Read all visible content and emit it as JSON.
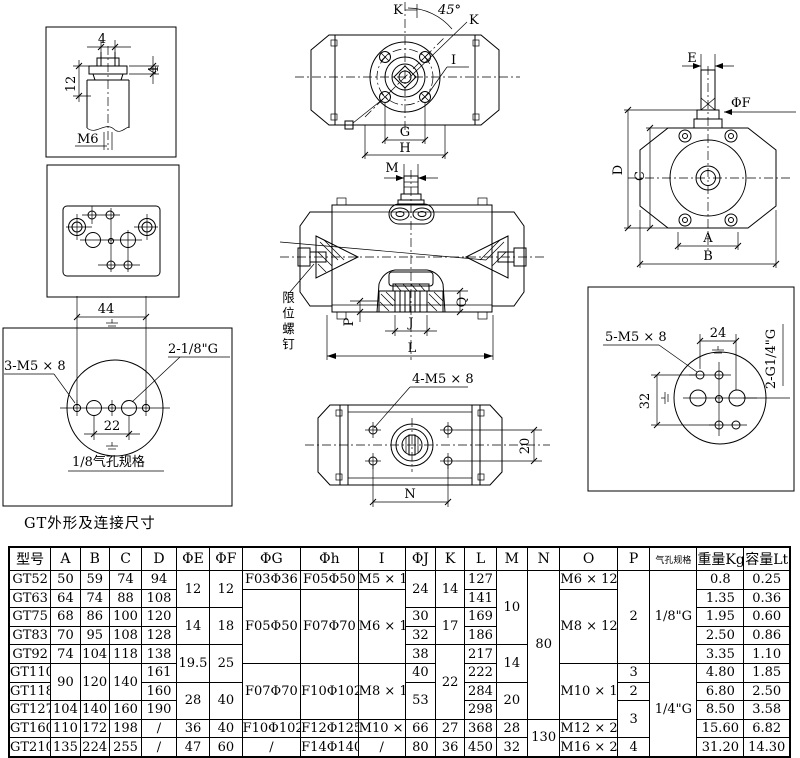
{
  "title": "GT外形及连接尺寸",
  "drawings": {
    "shaft_detail": {
      "slot_width": "4",
      "flange_thickness": "4",
      "height": "12",
      "thread": "M6"
    },
    "mount_plate": {
      "hole_spacing": "44"
    },
    "air_ports_small": {
      "screw_label": "3-M5 × 8",
      "port_label": "2-1/8\"G",
      "hole_spacing": "22",
      "caption": "1/8气孔规格"
    },
    "top_view": {
      "dim_k": "K",
      "angle": "45°",
      "dim_k2": "K",
      "label_i": "I",
      "dim_g": "G",
      "dim_h": "H"
    },
    "front_view": {
      "dim_m": "M",
      "limit_screw_label": "限位螺钉",
      "dim_p": "P",
      "dim_q": "Q",
      "dim_j": "J",
      "dim_l": "L"
    },
    "bottom_view": {
      "screw_label": "4-M5 × 8",
      "hole_spacing_v": "20",
      "dim_n": "N"
    },
    "end_view": {
      "dim_e": "E",
      "dim_f": "ΦF",
      "dim_d": "D",
      "dim_c": "C",
      "dim_a": "A",
      "dim_b": "B"
    },
    "air_ports_large": {
      "screw_label": "5-M5 × 8",
      "hole_spacing_h": "24",
      "port_label": "2-G1/4\"G",
      "hole_spacing_v": "32"
    }
  },
  "table": {
    "columns": [
      "型号",
      "A",
      "B",
      "C",
      "D",
      "ΦE",
      "ΦF",
      "ΦG",
      "Φh",
      "I",
      "ΦJ",
      "K",
      "L",
      "M",
      "N",
      "O",
      "P",
      "气孔规格",
      "重量Kg",
      "容量Lt"
    ],
    "rows": [
      [
        [
          "GT52"
        ],
        [
          "50"
        ],
        [
          "59"
        ],
        [
          "74"
        ],
        [
          "94"
        ],
        [
          "12",
          2
        ],
        [
          "12",
          2
        ],
        [
          "F03Φ36"
        ],
        [
          "F05Φ50"
        ],
        [
          "M5 × 10"
        ],
        [
          "24",
          2
        ],
        [
          "14",
          2
        ],
        [
          "127"
        ],
        [
          "10",
          4
        ],
        [
          "80",
          8
        ],
        [
          "M6 × 12"
        ],
        [
          "2",
          5
        ],
        [
          "1/8\"G",
          5
        ],
        [
          "0.8"
        ],
        [
          "0.25"
        ]
      ],
      [
        [
          "GT63"
        ],
        [
          "64"
        ],
        [
          "74"
        ],
        [
          "88"
        ],
        [
          "108"
        ],
        [
          "F05Φ50",
          4
        ],
        [
          "F07Φ70",
          4
        ],
        [
          "M6 × 10",
          4
        ],
        [
          "141"
        ],
        [
          "M8 × 12",
          4
        ],
        [
          "1.35"
        ],
        [
          "0.36"
        ]
      ],
      [
        [
          "GT75"
        ],
        [
          "68"
        ],
        [
          "86"
        ],
        [
          "100"
        ],
        [
          "120"
        ],
        [
          "14",
          2
        ],
        [
          "18",
          2
        ],
        [
          "30"
        ],
        [
          "17",
          2
        ],
        [
          "169"
        ],
        [
          "1.95"
        ],
        [
          "0.60"
        ]
      ],
      [
        [
          "GT83"
        ],
        [
          "70"
        ],
        [
          "95"
        ],
        [
          "108"
        ],
        [
          "128"
        ],
        [
          "32"
        ],
        [
          "186"
        ],
        [
          "2.50"
        ],
        [
          "0.86"
        ]
      ],
      [
        [
          "GT92"
        ],
        [
          "74"
        ],
        [
          "104"
        ],
        [
          "118"
        ],
        [
          "138"
        ],
        [
          "19.5",
          2
        ],
        [
          "25",
          2
        ],
        [
          "38"
        ],
        [
          "22",
          4
        ],
        [
          "217"
        ],
        [
          "14",
          2
        ],
        [
          "3.35"
        ],
        [
          "1.10"
        ]
      ],
      [
        [
          "GT110"
        ],
        [
          "90",
          2
        ],
        [
          "120",
          2
        ],
        [
          "140",
          2
        ],
        [
          "161"
        ],
        [
          "F07Φ70",
          3
        ],
        [
          "F10Φ102",
          3
        ],
        [
          "M8 × 12",
          3
        ],
        [
          "40"
        ],
        [
          "222"
        ],
        [
          "M10 × 16",
          3
        ],
        [
          "3"
        ],
        [
          "1/4\"G",
          5
        ],
        [
          "4.80"
        ],
        [
          "1.85"
        ]
      ],
      [
        [
          "GT118"
        ],
        [
          "160"
        ],
        [
          "28",
          2
        ],
        [
          "40",
          2
        ],
        [
          "53",
          2
        ],
        [
          "284"
        ],
        [
          "20",
          2
        ],
        [
          "2"
        ],
        [
          "6.80"
        ],
        [
          "2.50"
        ]
      ],
      [
        [
          "GT127"
        ],
        [
          "104"
        ],
        [
          "140"
        ],
        [
          "160"
        ],
        [
          "190"
        ],
        [
          "298"
        ],
        [
          "3",
          2
        ],
        [
          "8.50"
        ],
        [
          "3.58"
        ]
      ],
      [
        [
          "GT160"
        ],
        [
          "110"
        ],
        [
          "172"
        ],
        [
          "198"
        ],
        [
          "/"
        ],
        [
          "36"
        ],
        [
          "40"
        ],
        [
          "F10Φ102"
        ],
        [
          "F12Φ125"
        ],
        [
          "M10 × 16"
        ],
        [
          "66"
        ],
        [
          "27"
        ],
        [
          "368"
        ],
        [
          "28"
        ],
        [
          "130",
          2
        ],
        [
          "M12 × 20"
        ],
        [
          "15.60"
        ],
        [
          "6.82"
        ]
      ],
      [
        [
          "GT210"
        ],
        [
          "135"
        ],
        [
          "224"
        ],
        [
          "255"
        ],
        [
          "/"
        ],
        [
          "47"
        ],
        [
          "60"
        ],
        [
          "/"
        ],
        [
          "F14Φ140"
        ],
        [
          "/"
        ],
        [
          "80"
        ],
        [
          "36"
        ],
        [
          "450"
        ],
        [
          "32"
        ],
        [
          "M16 × 25"
        ],
        [
          "4"
        ],
        [
          "31.20"
        ],
        [
          "14.30"
        ]
      ]
    ]
  }
}
